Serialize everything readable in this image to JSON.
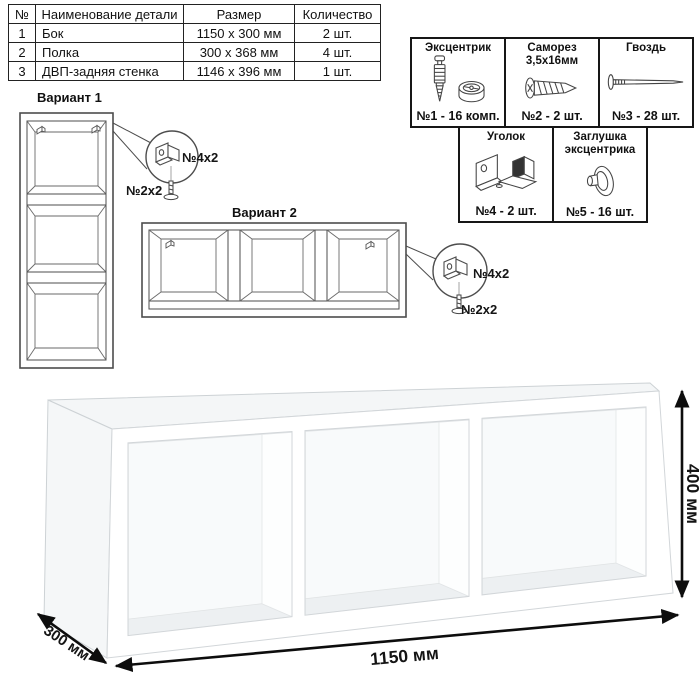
{
  "parts_table": {
    "headers": [
      "№",
      "Наименование детали",
      "Размер",
      "Количество"
    ],
    "rows": [
      {
        "num": "1",
        "name": "Бок",
        "size": "1150 x 300 мм",
        "qty": "2 шт."
      },
      {
        "num": "2",
        "name": "Полка",
        "size": "300 x 368 мм",
        "qty": "4 шт."
      },
      {
        "num": "3",
        "name": "ДВП-задняя стенка",
        "size": "1146 x 396 мм",
        "qty": "1 шт."
      }
    ]
  },
  "hardware": {
    "items": [
      {
        "title": "Эксцентрик",
        "caption": "№1 - 16 комп.",
        "icon": "eccentric-cam-icon"
      },
      {
        "title": "Саморез 3,5х16мм",
        "caption": "№2 - 2 шт.",
        "icon": "screw-icon"
      },
      {
        "title": "Гвоздь",
        "caption": "№3 - 28 шт.",
        "icon": "nail-icon"
      },
      {
        "title": "Уголок",
        "caption": "№4 - 2 шт.",
        "icon": "corner-bracket-icon"
      },
      {
        "title": "Заглушка эксцентрика",
        "caption": "№5 - 16 шт.",
        "icon": "eccentric-cap-icon"
      }
    ]
  },
  "variants": {
    "v1": {
      "title": "Вариант 1",
      "bracket_label": "№4х2",
      "screw_label": "№2х2"
    },
    "v2": {
      "title": "Вариант 2",
      "bracket_label": "№4х2",
      "screw_label": "№2х2"
    }
  },
  "dimensions": {
    "width": "1150 мм",
    "depth": "300 мм",
    "height": "400 мм"
  },
  "colors": {
    "line": "#4d4d4d",
    "text": "#111111",
    "table_border": "#222222",
    "shade": "#eef1f2"
  }
}
